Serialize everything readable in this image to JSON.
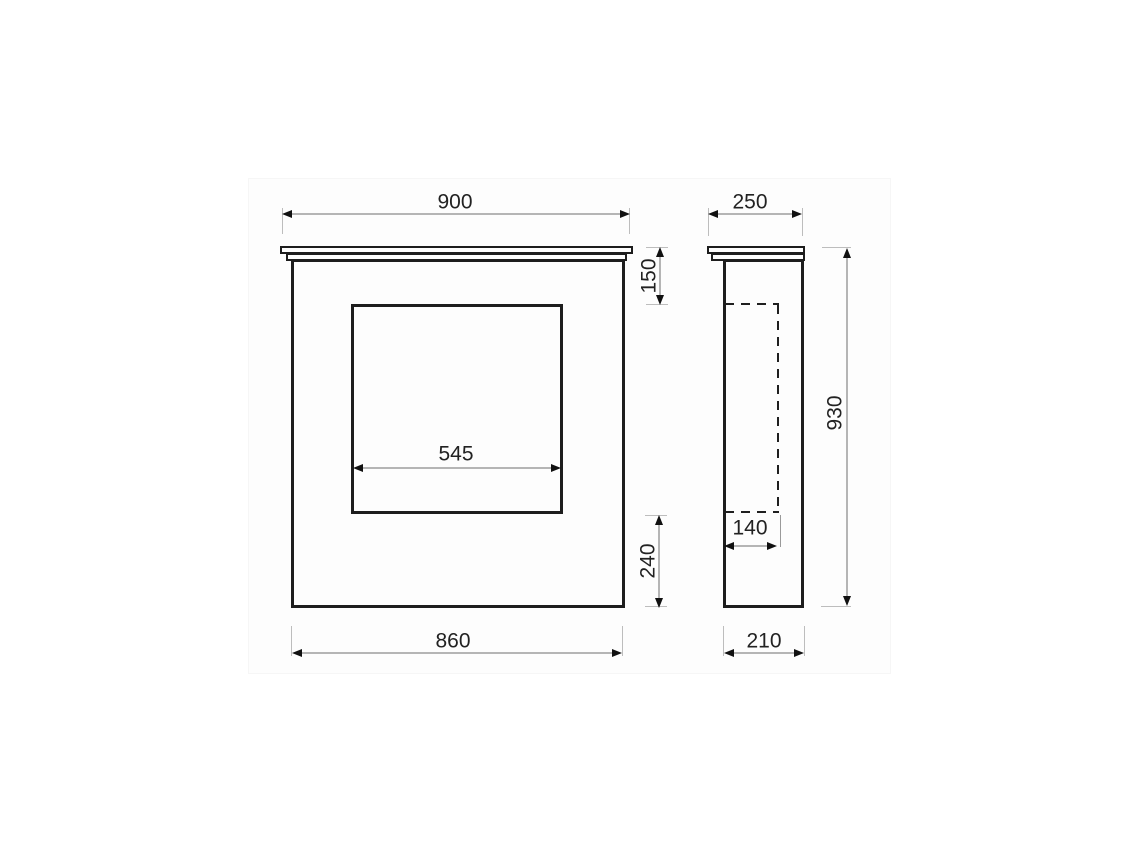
{
  "drawing": {
    "kind": "fireplace surround dimension drawing",
    "dimensions": {
      "front": {
        "shelf_width": "900",
        "opening_width": "545",
        "shelf_to_opening": "150",
        "opening_to_base": "240",
        "base_width": "860"
      },
      "side": {
        "shelf_depth": "250",
        "recess_depth": "140",
        "overall_height": "930",
        "base_depth": "210"
      }
    },
    "colors": {
      "outline": "#1d1d1d",
      "dimension_line": "#b5b5b5",
      "hidden_line": "#1f1f1f",
      "label_text": "#222222",
      "background": "#ffffff"
    }
  }
}
